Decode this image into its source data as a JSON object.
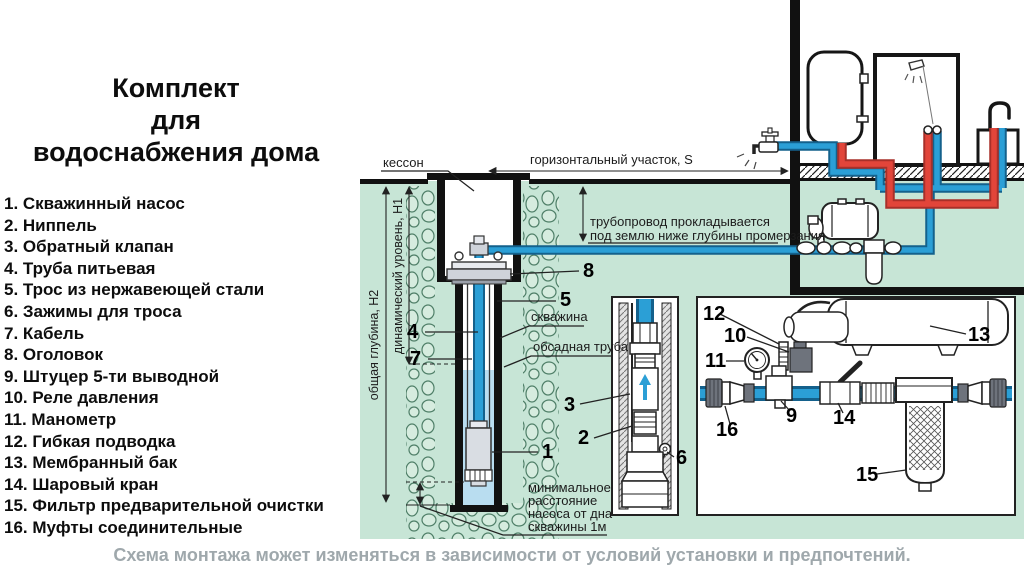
{
  "title": {
    "lines": [
      "Комплект",
      "для",
      "водоснабжения дома"
    ]
  },
  "legend": {
    "items": [
      "1. Скважинный насос",
      "2. Ниппель",
      "3. Обратный клапан",
      "4. Труба питьевая",
      "5. Трос из нержавеющей стали",
      "6. Зажимы для троса",
      "7. Кабель",
      "8. Оголовок",
      "9. Штуцер 5-ти выводной",
      "10. Реле давления",
      "11. Манометр",
      "12. Гибкая подводка",
      "13. Мембранный бак",
      "14. Шаровый кран",
      "15. Фильтр предварительной очистки",
      "16. Муфты соединительные"
    ]
  },
  "caption": "Схема монтажа может изменяться в зависимости от условий установки и предпочтений.",
  "diagram": {
    "labels": {
      "kesson": "кессон",
      "horizontal_section": "горизонтальный участок, S",
      "pipeline_note_1": "трубопровод прокладывается",
      "pipeline_note_2": "под землю ниже глубины промерзания",
      "borehole": "скважина",
      "casing_pipe": "обсадная труба",
      "total_depth": "общая глубина, Н2",
      "dynamic_level": "динамический уровень, Н1",
      "min_dist_1": "минимальное",
      "min_dist_2": "расстояние",
      "min_dist_3": "насоса от дна",
      "min_dist_4": "скважины 1м"
    },
    "callouts": {
      "c1": "1",
      "c2": "2",
      "c3": "3",
      "c4": "4",
      "c5": "5",
      "c6": "6",
      "c7": "7",
      "c8": "8",
      "c9": "9",
      "c10": "10",
      "c11": "11",
      "c12": "12",
      "c13": "13",
      "c14": "14",
      "c15": "15",
      "c16": "16"
    },
    "colors": {
      "ground": "#c7e5d6",
      "stone": "#4f7f68",
      "stone_fill": "#d6ecdf",
      "cold_pipe": "#2b9fd6",
      "cold_dark": "#14618c",
      "hot_pipe": "#e2453a",
      "hot_dark": "#a8302a",
      "water": "#b9ddf0",
      "caption_gray": "#9fa8ac"
    }
  }
}
